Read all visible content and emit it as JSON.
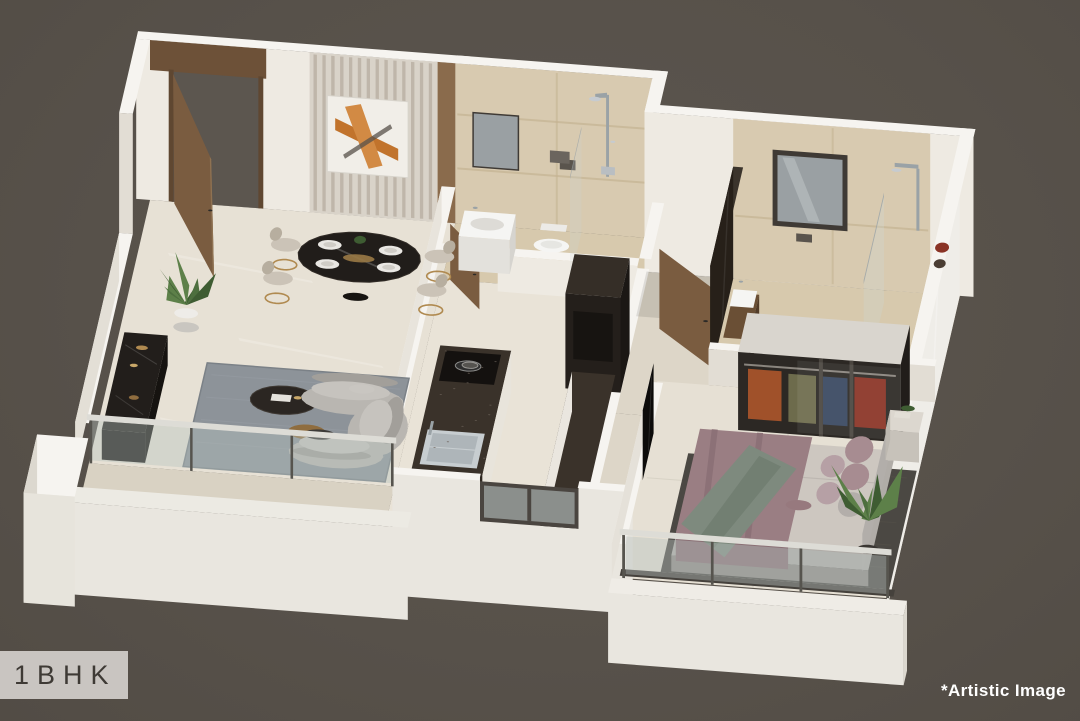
{
  "overlay": {
    "unit_label": "1BHK",
    "disclaimer": "*Artistic Image"
  },
  "palette": {
    "background": "#5c564f",
    "badge_bg": "#c9c5c1",
    "badge_text": "#3e3a35",
    "disclaimer_text": "#ffffff",
    "wall_top": "#f6f4f0",
    "wall_face": "#eeeae2",
    "wall_face_shade": "#e2ddd4",
    "wall_outer": "#e9e6df",
    "floor_living": "#e7e1d5",
    "floor_kitchen": "#e9e3d7",
    "floor_bath": "#d7c9ad",
    "bath_wall_marble": "#d8cab0",
    "floor_passage": "#ddd6c8",
    "floor_balcony": "#d9d2c3",
    "wood": "#7a5c40",
    "art_accent": "#c1732c",
    "sofa": "#b9b6b1",
    "rug_living": "#8d9399",
    "rug_bedroom": "#4b4843",
    "counter_granite": "#3a322a",
    "bed_duvet": "#9a7e83",
    "bed_throw": "#7e8a7e",
    "bed_sheet": "#cdc7c0",
    "glass": "#b7c2bf",
    "fixture_white": "#f5f5f3",
    "gold": "#b08a50"
  },
  "scene": {
    "type": "3d-isometric-floor-plan",
    "rooms": [
      "living-dining",
      "kitchen",
      "common-bathroom",
      "passage",
      "bedroom",
      "ensuite-bathroom",
      "living-balcony",
      "bedroom-balcony"
    ]
  }
}
